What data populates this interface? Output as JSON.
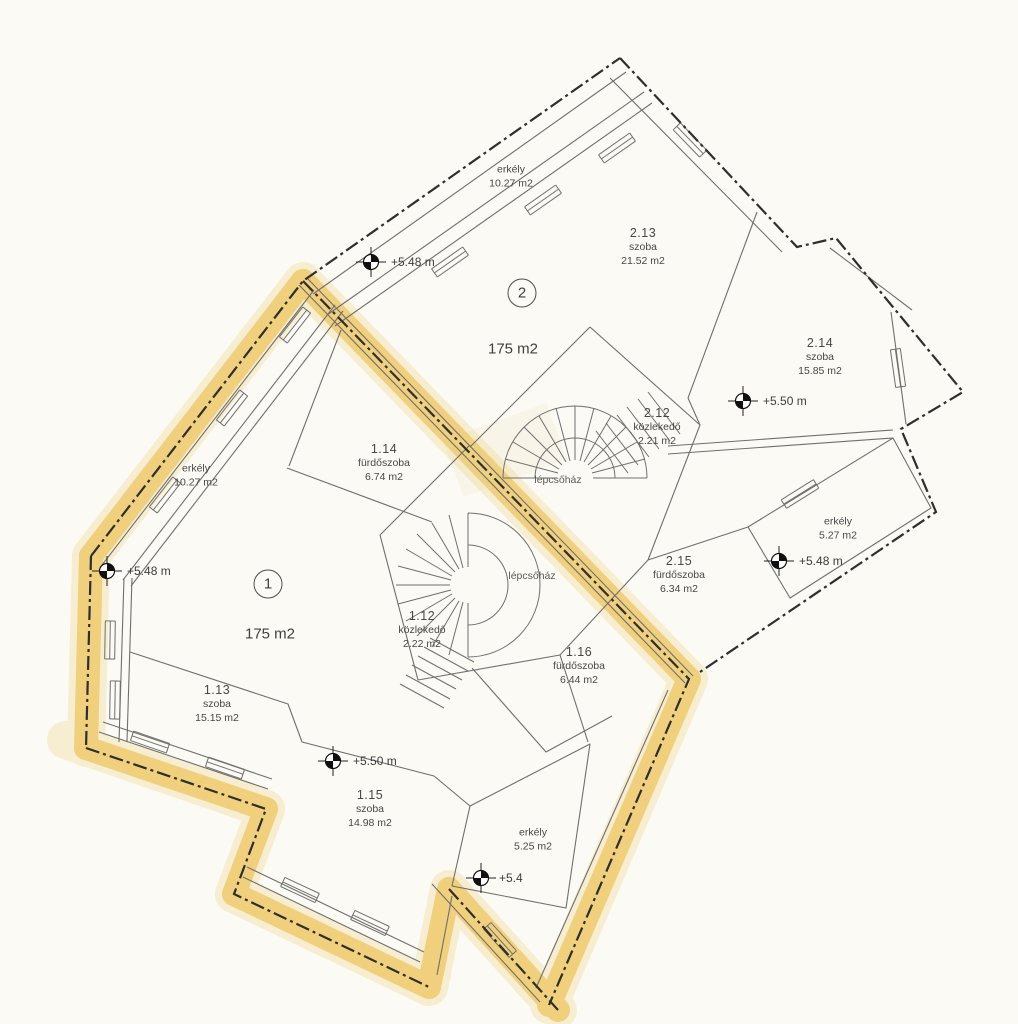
{
  "document_type": "floor-plan",
  "colors": {
    "highlight": "#EAB42C",
    "ink": "#474747",
    "paper": "#FBFAF5",
    "boundary_line": "#2e2e2e",
    "wall_line": "#6f6f6f"
  },
  "apartment2": {
    "number": "2",
    "area": "175 m2",
    "rooms": {
      "r213": {
        "code": "2.13",
        "name": "szoba",
        "area": "21.52 m2"
      },
      "r214": {
        "code": "2.14",
        "name": "szoba",
        "area": "15.85 m2"
      },
      "r212": {
        "code": "2.12",
        "name": "közlekedő",
        "area": "2.21 m2"
      },
      "r215": {
        "code": "2.15",
        "name": "fürdőszoba",
        "area": "6.34 m2"
      }
    },
    "balcony_top": {
      "name": "erkély",
      "area": "10.27 m2"
    },
    "balcony_right": {
      "name": "erkély",
      "area": "5.27 m2"
    },
    "stair": "lépcsőház",
    "elev_top": "+5.48 m",
    "elev_room": "+5.50 m",
    "elev_balcony": "+5.48 m"
  },
  "apartment1": {
    "number": "1",
    "area": "175 m2",
    "rooms": {
      "r114": {
        "code": "1.14",
        "name": "fürdőszoba",
        "area": "6.74 m2"
      },
      "r112": {
        "code": "1.12",
        "name": "közlekedő",
        "area": "2.22 m2"
      },
      "r116": {
        "code": "1.16",
        "name": "fürdőszoba",
        "area": "6.44 m2"
      },
      "r113": {
        "code": "1.13",
        "name": "szoba",
        "area": "15.15 m2"
      },
      "r115": {
        "code": "1.15",
        "name": "szoba",
        "area": "14.98 m2"
      }
    },
    "balcony_left": {
      "name": "erkély",
      "area": "10.27 m2"
    },
    "balcony_bottom": {
      "name": "erkély",
      "area": "5.25 m2"
    },
    "stair": "lépcsőház",
    "elev_left": "+5.48 m",
    "elev_room": "+5.50 m",
    "elev_balcony": "+5.4"
  }
}
